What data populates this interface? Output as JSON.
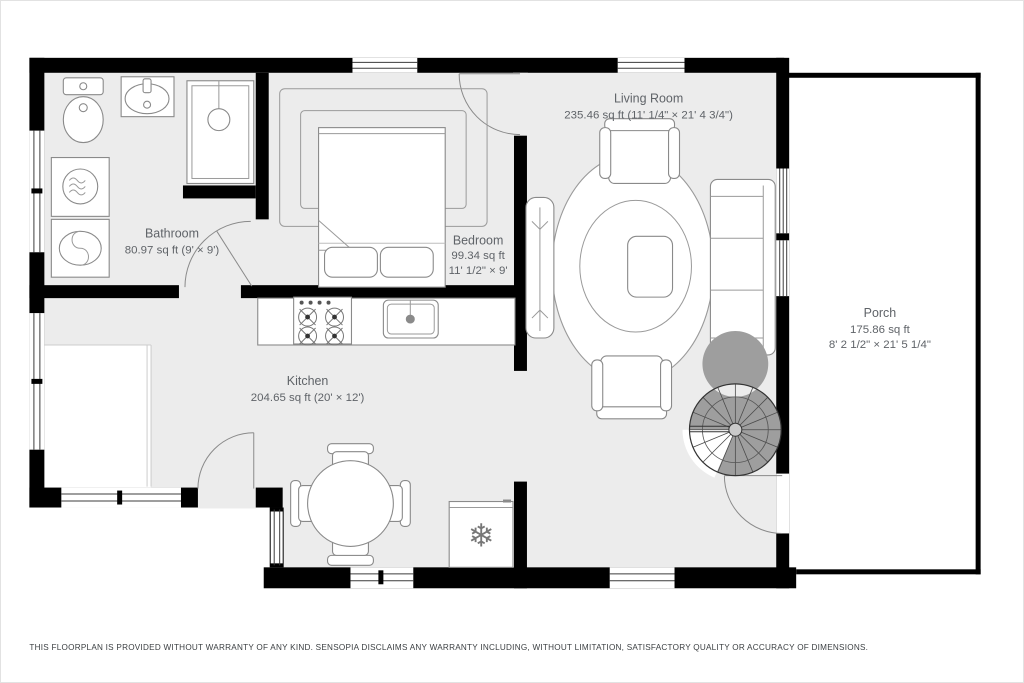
{
  "floorplan": {
    "rooms": {
      "living_room": {
        "name": "Living Room",
        "area": "235.46 sq ft (11' 1/4\" × 21' 4 3/4\")"
      },
      "bathroom": {
        "name": "Bathroom",
        "area": "80.97 sq ft (9' × 9')"
      },
      "bedroom": {
        "name": "Bedroom",
        "area": "99.34 sq ft",
        "dimensions": "11' 1/2\" × 9'"
      },
      "kitchen": {
        "name": "Kitchen",
        "area": "204.65 sq ft (20' × 12')"
      },
      "porch": {
        "name": "Porch",
        "area": "175.86 sq ft",
        "dimensions": "8' 2 1/2\" × 21' 5 1/4\""
      }
    },
    "icons": {
      "freezer": "❄"
    },
    "disclaimer": "THIS FLOORPLAN IS PROVIDED WITHOUT WARRANTY OF ANY KIND. SENSOPIA DISCLAIMS ANY WARRANTY INCLUDING, WITHOUT LIMITATION, SATISFACTORY QUALITY OR ACCURACY OF DIMENSIONS.",
    "colors": {
      "wall": "#000000",
      "floor": "#ececec",
      "furniture_stroke": "#8a8a8a",
      "label_text": "#5f6368",
      "stair_gray": "#9e9e9e",
      "background": "#ffffff"
    }
  }
}
